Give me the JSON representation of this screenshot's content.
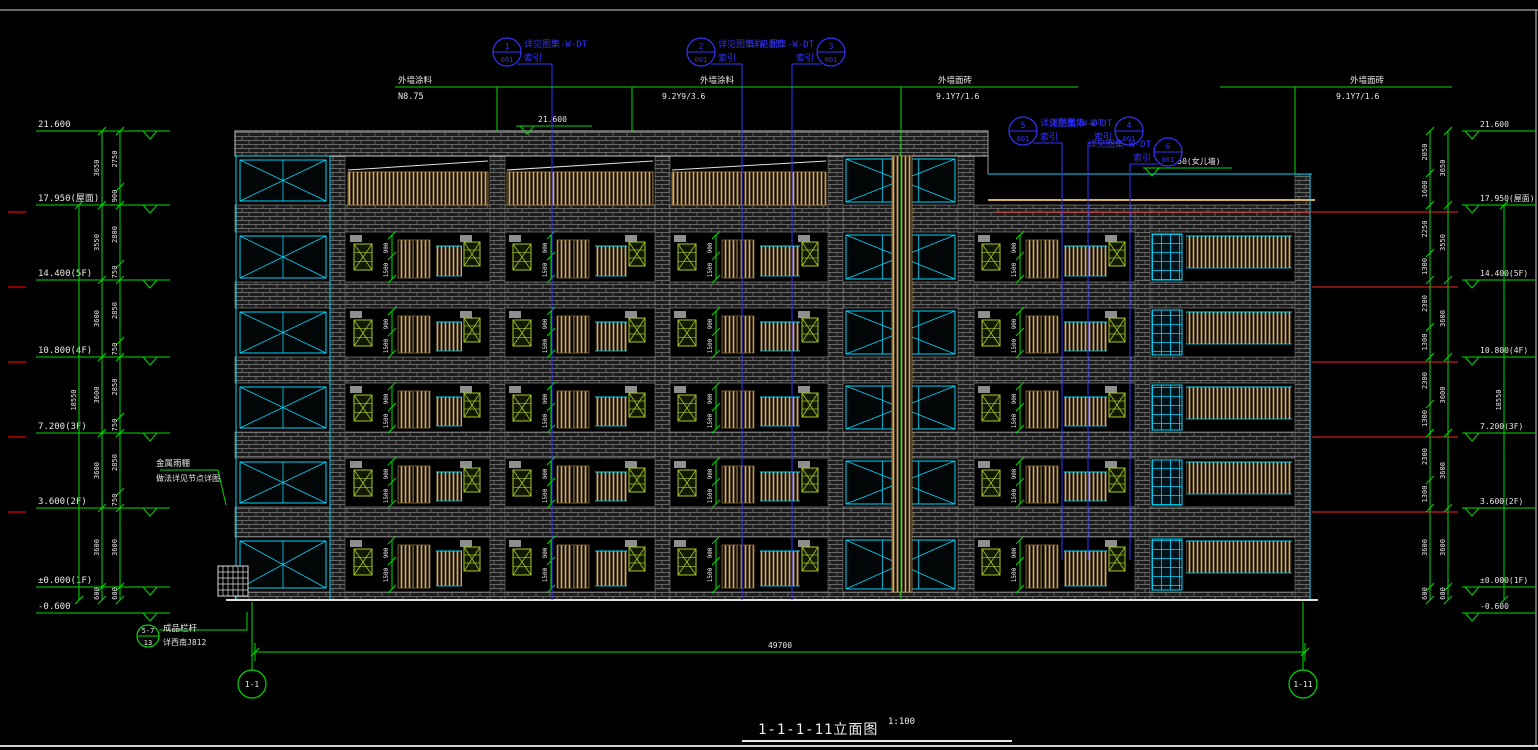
{
  "title": {
    "text": "1-1-1-11立面图",
    "scale": "1:100"
  },
  "colors": {
    "bg": "#000000",
    "green": "#00dc00",
    "blue": "#3232ff",
    "cyan": "#00d8ff",
    "white": "#e8e8e8",
    "tan": "#d7ac60",
    "tanline": "#b08d4e",
    "louver": "#a6c828",
    "red": "#ff2222",
    "darkred": "#8b0000",
    "gray": "#8f8f8f",
    "frame": "#d0d0d0"
  },
  "callout_label": "详见图集-W-DT",
  "callout_sub": "索引",
  "callouts": [
    {
      "num": "1",
      "sheet": "001",
      "cx": 507,
      "cy": 52,
      "side": "right",
      "lx": 552,
      "ly2": 600
    },
    {
      "num": "2",
      "sheet": "001",
      "cx": 701,
      "cy": 52,
      "side": "right",
      "lx": 742,
      "ly2": 600
    },
    {
      "num": "3",
      "sheet": "001",
      "cx": 831,
      "cy": 52,
      "side": "left",
      "lx": 792,
      "ly2": 600
    },
    {
      "num": "5",
      "sheet": "001",
      "cx": 1023,
      "cy": 131,
      "side": "right",
      "lx": 1062,
      "ly2": 560
    },
    {
      "num": "4",
      "sheet": "001",
      "cx": 1129,
      "cy": 131,
      "side": "left",
      "lx": 1088,
      "ly2": 560
    },
    {
      "num": "6",
      "sheet": "001",
      "cx": 1168,
      "cy": 152,
      "side": "left",
      "lx": 1130,
      "ly2": 560
    }
  ],
  "markers_left": [
    {
      "t": "21.600",
      "y": 131
    },
    {
      "t": "17.950(屋面)",
      "y": 205
    },
    {
      "t": "14.400(5F)",
      "y": 280
    },
    {
      "t": "10.800(4F)",
      "y": 357
    },
    {
      "t": "7.200(3F)",
      "y": 433
    },
    {
      "t": "3.600(2F)",
      "y": 508
    },
    {
      "t": "±0.000(1F)",
      "y": 587
    },
    {
      "t": "-0.600",
      "y": 613
    }
  ],
  "markers_right": [
    {
      "t": "21.600",
      "y": 131
    },
    {
      "t": "17.950(屋面)",
      "y": 205
    },
    {
      "t": "14.400(5F)",
      "y": 280
    },
    {
      "t": "10.800(4F)",
      "y": 357
    },
    {
      "t": "7.200(3F)",
      "y": 433
    },
    {
      "t": "3.600(2F)",
      "y": 508
    },
    {
      "t": "±0.000(1F)",
      "y": 587
    },
    {
      "t": "-0.600",
      "y": 613
    }
  ],
  "markers_inline": [
    {
      "t": "21.600",
      "tx": 538,
      "ty": 122,
      "line": [
        516,
        126,
        592
      ],
      "apex": [
        527,
        126
      ]
    },
    {
      "t": "19.550(女儿墙)",
      "tx": 1158,
      "ty": 164,
      "line": [
        1143,
        168,
        1232
      ],
      "apex": [
        1152,
        168
      ]
    }
  ],
  "dims": {
    "floor_bounds": [
      131,
      205,
      280,
      357,
      433,
      508,
      587,
      600
    ],
    "floor_vals": [
      "3650",
      "3550",
      "3600",
      "3600",
      "3600",
      "3600",
      "600"
    ],
    "left_sub_bounds": [
      131,
      187,
      205,
      264,
      280,
      341,
      357,
      417,
      433,
      492,
      508,
      587,
      600
    ],
    "left_sub_vals": [
      "2750",
      "900",
      "2800",
      "750",
      "2850",
      "750",
      "2850",
      "750",
      "2850",
      "750",
      "3600",
      "600"
    ],
    "right_sub_bounds": [
      131,
      173,
      205,
      253,
      280,
      327,
      357,
      404,
      433,
      480,
      508,
      587,
      600
    ],
    "right_sub_vals": [
      "2050",
      "1600",
      "2250",
      "1300",
      "2300",
      "1300",
      "2300",
      "1300",
      "2300",
      "1300",
      "3600",
      "600"
    ],
    "total": "18550",
    "left_x": {
      "floor": 102,
      "sub": 120,
      "total": 79
    },
    "right_x": {
      "floor": 1448,
      "sub": 1430,
      "total": 1504
    }
  },
  "bottom_dim": {
    "y": 652,
    "x1": 255,
    "x2": 1305,
    "label": "49700"
  },
  "axis_bubbles": [
    {
      "t": "1-1",
      "cx": 252,
      "cy": 684
    },
    {
      "t": "1-11",
      "cx": 1303,
      "cy": 684
    }
  ],
  "leaders": [
    {
      "pts": [
        [
          395,
          87
        ],
        [
          1078,
          87
        ]
      ]
    },
    {
      "pts": [
        [
          497,
          87
        ],
        [
          497,
          131
        ]
      ]
    },
    {
      "pts": [
        [
          632,
          87
        ],
        [
          632,
          131
        ]
      ]
    },
    {
      "pts": [
        [
          901,
          600
        ],
        [
          901,
          87
        ]
      ]
    },
    {
      "pts": [
        [
          1220,
          87
        ],
        [
          1452,
          87
        ]
      ]
    },
    {
      "pts": [
        [
          1295,
          87
        ],
        [
          1295,
          174
        ]
      ]
    },
    {
      "pts": [
        [
          160,
          470
        ],
        [
          218,
          470
        ],
        [
          226,
          505
        ]
      ]
    },
    {
      "pts": [
        [
          159,
          630
        ],
        [
          247,
          630
        ],
        [
          247,
          612
        ]
      ]
    }
  ],
  "leader_texts": [
    {
      "t": "外墙涂料",
      "x": 398,
      "y": 83
    },
    {
      "t": "N8.75",
      "x": 398,
      "y": 99
    },
    {
      "t": "外墙涂料",
      "x": 700,
      "y": 83
    },
    {
      "t": "9.2Y9/3.6",
      "x": 662,
      "y": 99
    },
    {
      "t": "外墙面砖",
      "x": 938,
      "y": 83
    },
    {
      "t": "9.1Y7/1.6",
      "x": 936,
      "y": 99
    },
    {
      "t": "外墙面砖",
      "x": 1350,
      "y": 83
    },
    {
      "t": "9.1Y7/1.6",
      "x": 1336,
      "y": 99
    },
    {
      "t": "金属雨棚",
      "x": 156,
      "y": 466
    },
    {
      "t": "做法详见节点详图",
      "x": 156,
      "y": 481
    },
    {
      "t": "成品栏杆",
      "x": 163,
      "y": 631
    },
    {
      "t": "详西南J812",
      "x": 163,
      "y": 645
    }
  ],
  "note_bubble": {
    "cx": 148,
    "cy": 636,
    "r": 11,
    "top": "5-7",
    "bottom": "13"
  },
  "red_lines": [
    {
      "x1": 995,
      "y": 212,
      "x2": 1458
    },
    {
      "x1": 1312,
      "y": 287,
      "x2": 1458
    },
    {
      "x1": 1312,
      "y": 362,
      "x2": 1458
    },
    {
      "x1": 1312,
      "y": 437,
      "x2": 1458
    },
    {
      "x1": 1312,
      "y": 512,
      "x2": 1458
    }
  ],
  "red_tick_ys": [
    212,
    287,
    362,
    437,
    512
  ],
  "building": {
    "left": 235,
    "right": 1310,
    "top": 131,
    "bottom": 600,
    "parapet": {
      "x1": 235,
      "x2": 988,
      "y1": 131,
      "y2": 156
    },
    "piers": [
      {
        "x": 330,
        "w": 15
      },
      {
        "x": 490,
        "w": 15
      },
      {
        "x": 655,
        "w": 15
      },
      {
        "x": 828,
        "w": 15
      },
      {
        "x": 958,
        "w": 16
      },
      {
        "x": 1135,
        "w": 15,
        "top": 205
      },
      {
        "x": 1295,
        "w": 15,
        "top": 174
      }
    ],
    "slabs": [
      {
        "y": 205,
        "h": 27
      },
      {
        "y": 282,
        "h": 26
      },
      {
        "y": 357,
        "h": 26
      },
      {
        "y": 432,
        "h": 26
      },
      {
        "y": 507,
        "h": 30
      },
      {
        "y": 592,
        "h": 8
      }
    ],
    "cells": [
      {
        "y": 156,
        "h": 49
      },
      {
        "y": 232,
        "h": 50
      },
      {
        "y": 308,
        "h": 49
      },
      {
        "y": 383,
        "h": 49
      },
      {
        "y": 458,
        "h": 49
      },
      {
        "y": 537,
        "h": 55
      }
    ],
    "tower": {
      "x": 236,
      "w": 94
    },
    "stair_bay": {
      "x": 843,
      "w": 115
    },
    "elevator_strip": {
      "x": 892,
      "w": 20,
      "y": 156,
      "h": 436
    },
    "typical_bays": [
      {
        "x": 346,
        "w": 144
      },
      {
        "x": 505,
        "w": 150
      },
      {
        "x": 670,
        "w": 158
      },
      {
        "x": 974,
        "w": 161
      }
    ],
    "top_strip_bays": [
      0,
      1,
      2
    ],
    "corridor": {
      "x": 1150,
      "w": 145,
      "win_x": 1152,
      "win_w": 30,
      "rail_x": 1186,
      "rail_x2": 1292,
      "roof_y": 174,
      "tan_y": 200
    },
    "window_dims": [
      "900",
      "1500"
    ],
    "ground": {
      "y": 600,
      "x1": 226,
      "x2": 1318
    },
    "steps": {
      "x": 218,
      "y": 566,
      "w": 30,
      "h": 30
    }
  }
}
